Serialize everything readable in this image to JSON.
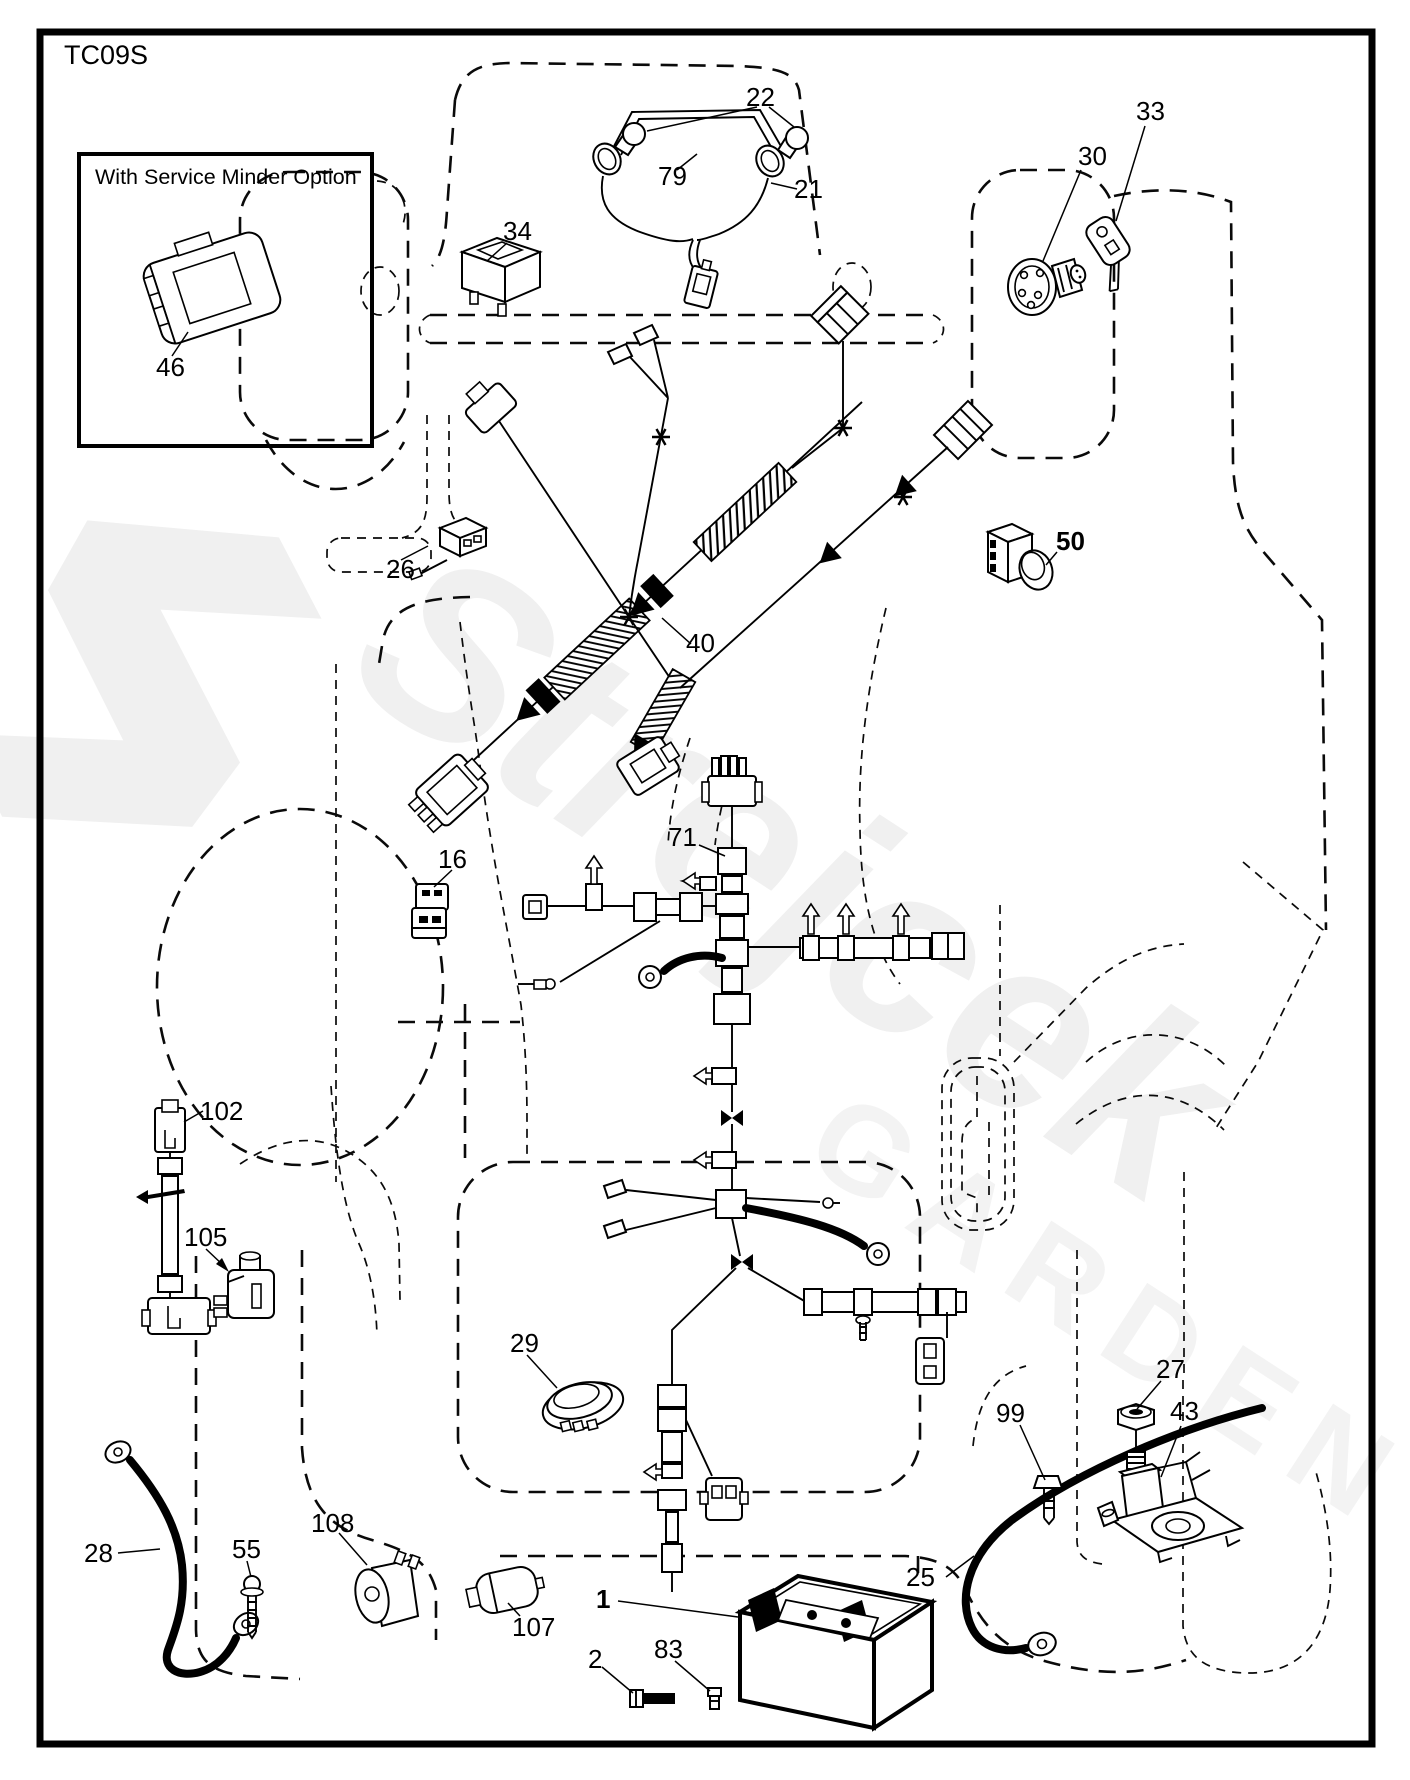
{
  "page": {
    "code": "TC09S"
  },
  "inset": {
    "title": "With Service Minder Option"
  },
  "watermark": {
    "brand": "Strejcek",
    "sub": "GARDEN"
  },
  "parts": [
    {
      "num": "1",
      "x": 596,
      "y": 1586,
      "bold": true
    },
    {
      "num": "2",
      "x": 588,
      "y": 1646
    },
    {
      "num": "16",
      "x": 438,
      "y": 846
    },
    {
      "num": "21",
      "x": 794,
      "y": 176
    },
    {
      "num": "22",
      "x": 746,
      "y": 84
    },
    {
      "num": "25",
      "x": 906,
      "y": 1564
    },
    {
      "num": "26",
      "x": 386,
      "y": 556
    },
    {
      "num": "27",
      "x": 1156,
      "y": 1356
    },
    {
      "num": "28",
      "x": 84,
      "y": 1540
    },
    {
      "num": "29",
      "x": 510,
      "y": 1330
    },
    {
      "num": "30",
      "x": 1078,
      "y": 143
    },
    {
      "num": "33",
      "x": 1136,
      "y": 98
    },
    {
      "num": "34",
      "x": 503,
      "y": 218
    },
    {
      "num": "40",
      "x": 686,
      "y": 630
    },
    {
      "num": "43",
      "x": 1170,
      "y": 1398
    },
    {
      "num": "46",
      "x": 156,
      "y": 354
    },
    {
      "num": "50",
      "x": 1056,
      "y": 528,
      "bold": true
    },
    {
      "num": "55",
      "x": 232,
      "y": 1536
    },
    {
      "num": "71",
      "x": 668,
      "y": 824
    },
    {
      "num": "79",
      "x": 658,
      "y": 163
    },
    {
      "num": "83",
      "x": 654,
      "y": 1636
    },
    {
      "num": "99",
      "x": 996,
      "y": 1400
    },
    {
      "num": "102",
      "x": 200,
      "y": 1098
    },
    {
      "num": "105",
      "x": 184,
      "y": 1224
    },
    {
      "num": "107",
      "x": 512,
      "y": 1614
    },
    {
      "num": "108",
      "x": 311,
      "y": 1510
    }
  ]
}
